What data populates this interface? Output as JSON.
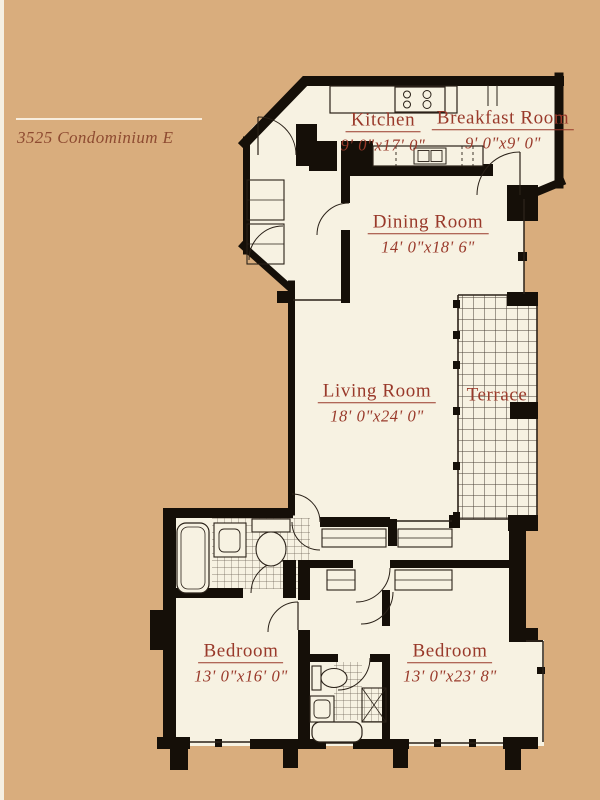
{
  "title": {
    "text": "3525 Condominium E"
  },
  "colors": {
    "background": "#d9ad7d",
    "plan_floor": "#f7f2e2",
    "walls": "#150f08",
    "room_labels": "#99392a",
    "title_text": "#8e4b31"
  },
  "rooms": {
    "kitchen": {
      "name": "Kitchen",
      "dims": "9' 0\"x17' 0\""
    },
    "breakfast": {
      "name": "Breakfast Room",
      "dims": "9' 0\"x9' 0\""
    },
    "dining": {
      "name": "Dining Room",
      "dims": "14' 0\"x18' 6\""
    },
    "living": {
      "name": "Living Room",
      "dims": "18' 0\"x24' 0\""
    },
    "terrace": {
      "name": "Terrace",
      "dims": ""
    },
    "bedroom_left": {
      "name": "Bedroom",
      "dims": "13' 0\"x16' 0\""
    },
    "bedroom_right": {
      "name": "Bedroom",
      "dims": "13' 0\"x23' 8\""
    }
  }
}
